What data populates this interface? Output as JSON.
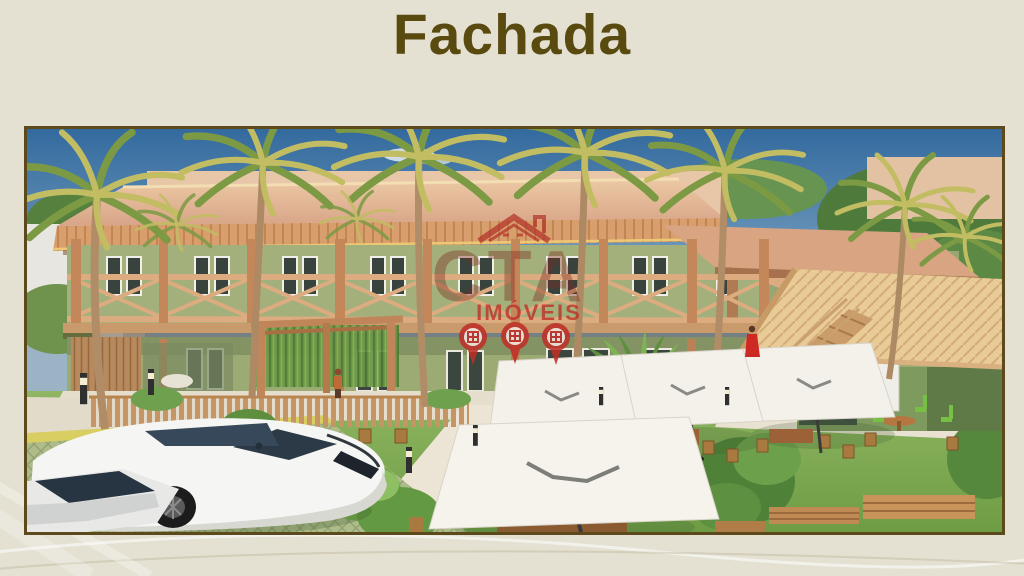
{
  "slide": {
    "title": "Fachada"
  },
  "theme": {
    "background_color": "#e4e1d2",
    "title_color": "#594a0f",
    "frame_border_color": "#5c4a1d"
  },
  "watermark": {
    "company": "CTA",
    "word": "IMÓVEIS",
    "red": "#bf2f27",
    "icons": [
      "house-roof-icon",
      "map-pin-icon",
      "map-pin-icon",
      "map-pin-icon"
    ]
  },
  "scene": {
    "palette": {
      "sky": "#4a7dab",
      "roof_tan": "#d8a488",
      "wall_green": "#9fae78",
      "wood": "#c79368",
      "lawn_green": "#84ae57",
      "path_beige": "#e9e1d0",
      "umbrella_white": "#f3f1ea"
    }
  }
}
